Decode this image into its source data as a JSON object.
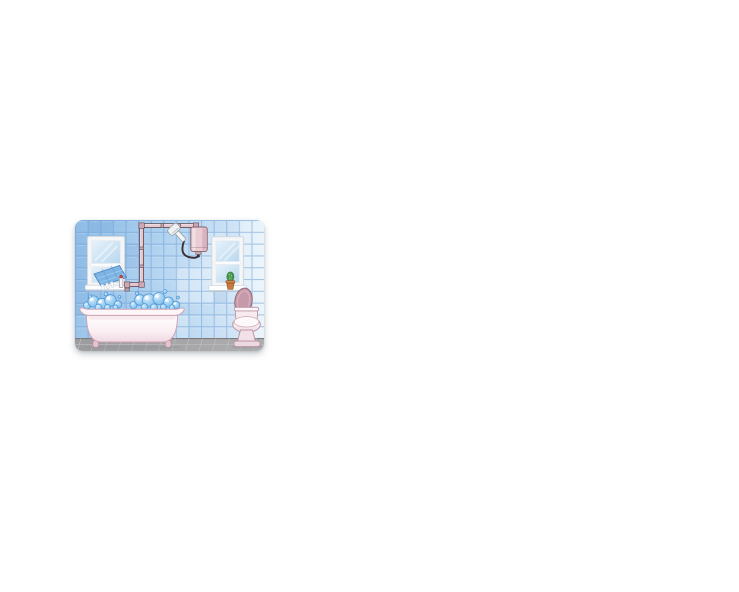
{
  "page": {
    "background_color": "#ffffff"
  },
  "illustration": {
    "alt": "Cartoon bathroom: blue tiled wall, two white windows, clawfoot bathtub full of blue bubbles, toilet with open lid, wall pipes feeding a small water heater with hand shower, blue towel and dispenser under the left window, potted cactus on the right windowsill, gray tiled floor",
    "position": {
      "left": 75,
      "top": 220,
      "width": 189,
      "height": 131
    },
    "objects": [
      "wall-tiles",
      "floor-tiles",
      "left-window",
      "towel",
      "soap-dispenser",
      "water-pipes",
      "shower-head",
      "water-heater",
      "right-window",
      "cactus-plant",
      "bathtub",
      "bubbles",
      "toilet"
    ],
    "colors": {
      "wall_tile_left": "#8fbce6",
      "wall_tile_mid": "#a5ccee",
      "wall_tile_right": "#dceefa",
      "wall_grout": "#6fa0d2",
      "floor": "#a5a5a7",
      "floor_dark_line": "#7c7c7e",
      "floor_light_line": "#bcbcbe",
      "window_frame": "#f4f6f8",
      "window_frame_edge": "#d3d9de",
      "glass_light": "#e6f2fb",
      "glass_dark": "#b9d7ee",
      "towel": "#7db4e3",
      "towel_stripe": "#aacfef",
      "towel_edge": "#4c84c0",
      "pipe_fill": "#e6c6cf",
      "pipe_outline": "#5d4d55",
      "pipe_joint": "#cfa7b3",
      "heater": "#ecccd4",
      "heater_shade": "#d9b0bd",
      "heater_outline": "#7c5f6a",
      "shower_white": "#f3f5f7",
      "shower_outline": "#99a1a8",
      "hose": "#3a3136",
      "tub_white": "#fffdfe",
      "tub_shade": "#f0d9e2",
      "tub_outline": "#cfa4b5",
      "tub_rim": "#fdf6f9",
      "foot_pink": "#e8c3cf",
      "bubble_light": "#e3f2fc",
      "bubble_mid": "#79bdec",
      "bubble_outline": "#4f99d8",
      "suds": "#aed6f2",
      "toilet_body": "#f9eef2",
      "toilet_lid": "#c59aa9",
      "toilet_lid_outline": "#95697a",
      "toilet_outline": "#bb92a2",
      "cactus_green": "#55a057",
      "cactus_dark": "#337a3b",
      "pot_orange": "#c87a3c",
      "pot_dark": "#94562a",
      "dispenser_cap_red": "#cc4a3e",
      "shadow": "#8a9096"
    }
  }
}
